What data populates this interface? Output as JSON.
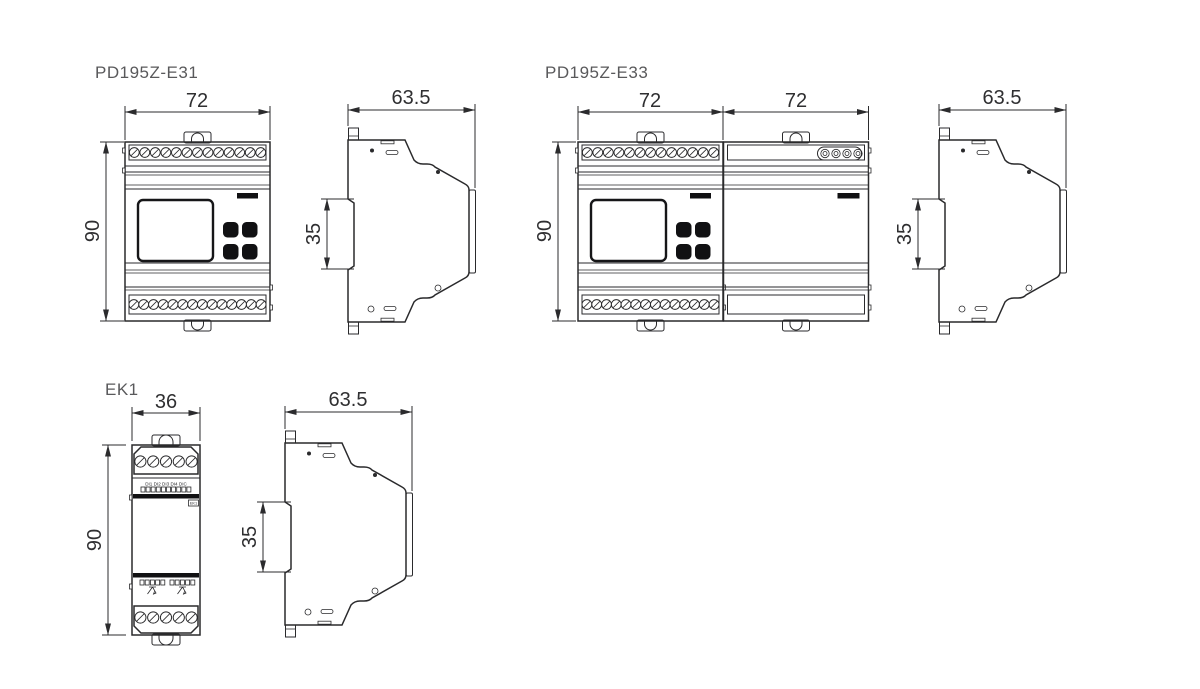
{
  "page": {
    "background": "#ffffff",
    "line_color": "#2a2a2c",
    "accent_black": "#111113"
  },
  "e31": {
    "title": "PD195Z-E31",
    "front_width": "72",
    "height": "90",
    "side_width": "63.5",
    "din_clip": "35"
  },
  "e33": {
    "title": "PD195Z-E33",
    "front_width_left": "72",
    "front_width_right": "72",
    "height": "90",
    "side_width": "63.5",
    "din_clip": "35"
  },
  "ek1": {
    "title": "EK1",
    "front_width": "36",
    "height": "90",
    "side_width": "63.5",
    "din_clip": "35",
    "di_labels": "DI1 DI2 DI3 DI4 DIC",
    "device_label": "EK1"
  }
}
